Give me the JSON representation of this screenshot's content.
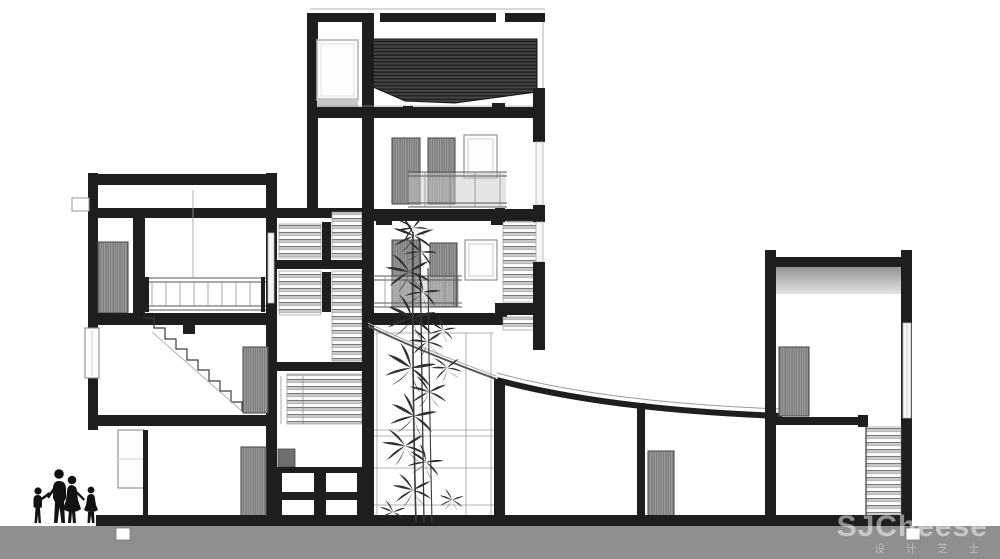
{
  "watermark": {
    "brand": "SJCheese",
    "caption": "设 计 芝 士"
  },
  "figures": {
    "family_members": 4
  },
  "colors": {
    "ink": "#1e1e1e",
    "paper": "#ffffff",
    "ground": "#8f8f8f",
    "door-wood": "#8d8d8d",
    "glass": "#c9c9c9",
    "roof-hatch": "#3e3e3e",
    "thin-line": "#9b9b9b",
    "watermark": "#ffffff"
  }
}
